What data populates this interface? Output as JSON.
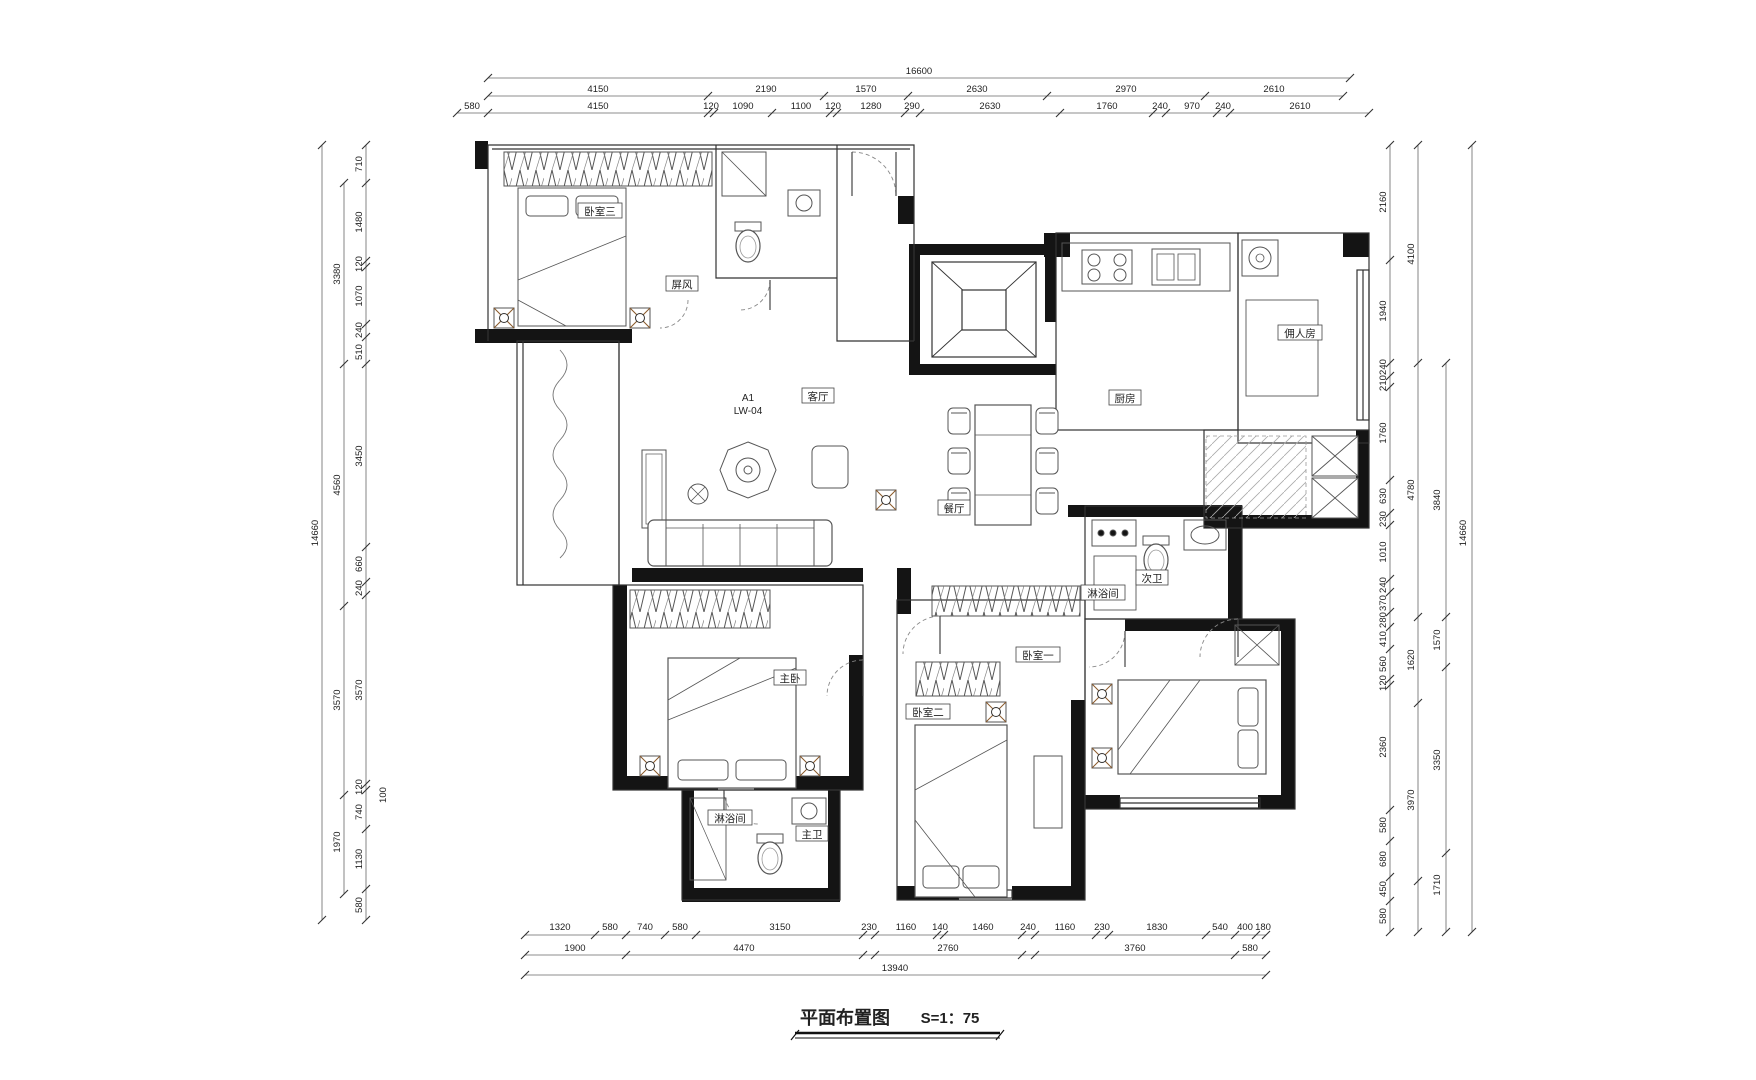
{
  "title": {
    "text": "平面布置图",
    "scale": "S=1：75"
  },
  "markers": {
    "grid": "A1",
    "code": "LW-04"
  },
  "rooms": {
    "bedroom3": "卧室三",
    "screen": "屏风",
    "living": "客厅",
    "dining": "餐厅",
    "kitchen": "厨房",
    "maid": "佣人房",
    "bath2": "次卫",
    "shower2": "淋浴间",
    "master": "主卧",
    "bedroom2": "卧室二",
    "bedroom1": "卧室一",
    "shower1": "淋浴间",
    "bath1": "主卫"
  },
  "dims": {
    "top": {
      "overall": "16600",
      "mid": [
        "4150",
        "2190",
        "1570",
        "2630",
        "2970",
        "2610"
      ],
      "detail": [
        "580",
        "4150",
        "120",
        "1090",
        "1100",
        "120",
        "1280",
        "290",
        "2630",
        "1760",
        "240",
        "970",
        "240",
        "2610"
      ]
    },
    "bottom": {
      "detail": [
        "1320",
        "580",
        "740",
        "580",
        "3150",
        "230",
        "1160",
        "140",
        "1460",
        "240",
        "1160",
        "230",
        "1830",
        "540",
        "400",
        "180"
      ],
      "mid": [
        "1900",
        "4470",
        "2760",
        "3760",
        "580"
      ],
      "overall": "13940"
    },
    "left": {
      "detail": [
        "710",
        "1480",
        "120",
        "1070",
        "240",
        "510",
        "3450",
        "660",
        "240",
        "3570",
        "120",
        "740",
        "100",
        "1130",
        "580"
      ],
      "mid": [
        "3380",
        "4560",
        "3570",
        "1970"
      ],
      "overall": "14660"
    },
    "right": {
      "detail": [
        "2160",
        "1940",
        "240",
        "210",
        "1760",
        "630",
        "230",
        "1010",
        "240",
        "370",
        "280",
        "410",
        "560",
        "120",
        "2360",
        "580",
        "680",
        "450",
        "580"
      ],
      "mid": [
        "4100",
        "4780",
        "1620",
        "3970"
      ],
      "mid2": [
        "3840",
        "1570",
        "3350",
        "1710"
      ],
      "overall": "14660"
    }
  }
}
